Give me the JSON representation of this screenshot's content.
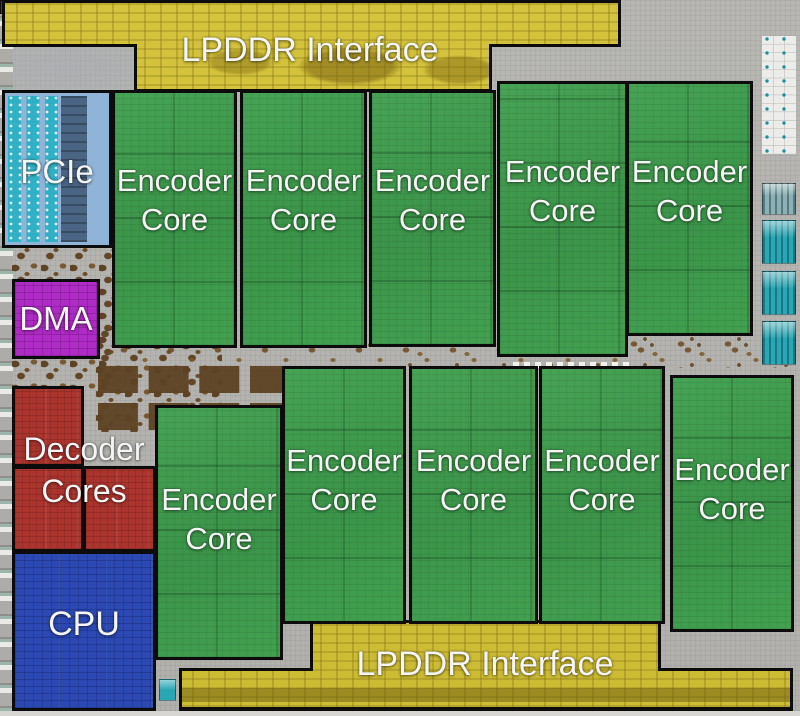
{
  "blocks": {
    "lpddr_top": {
      "label": "LPDDR Interface"
    },
    "lpddr_bottom": {
      "label": "LPDDR Interface"
    },
    "pcie": {
      "label": "PCIe"
    },
    "dma": {
      "label": "DMA"
    },
    "decoder": {
      "line1": "Decoder",
      "line2": "Cores"
    },
    "cpu": {
      "label": "CPU"
    },
    "encoder": {
      "line1": "Encoder",
      "line2": "Core",
      "count": 10
    }
  },
  "colors": {
    "lpddr_yellow": "#d2c13a",
    "encoder_green": "#3d9a4c",
    "decoder_red": "#ac342e",
    "cpu_blue": "#2c49b3",
    "dma_purple": "#ae2bc5",
    "pcie_blue": "#8fb4d8",
    "pcie_teal": "#2fb0c4",
    "die_gray": "#b4b3af",
    "dirt_brown": "#6f4d26",
    "pad_teal": "#2aa7b5",
    "label_white": "#f5f5f5",
    "outline_black": "#0c0c0c"
  }
}
